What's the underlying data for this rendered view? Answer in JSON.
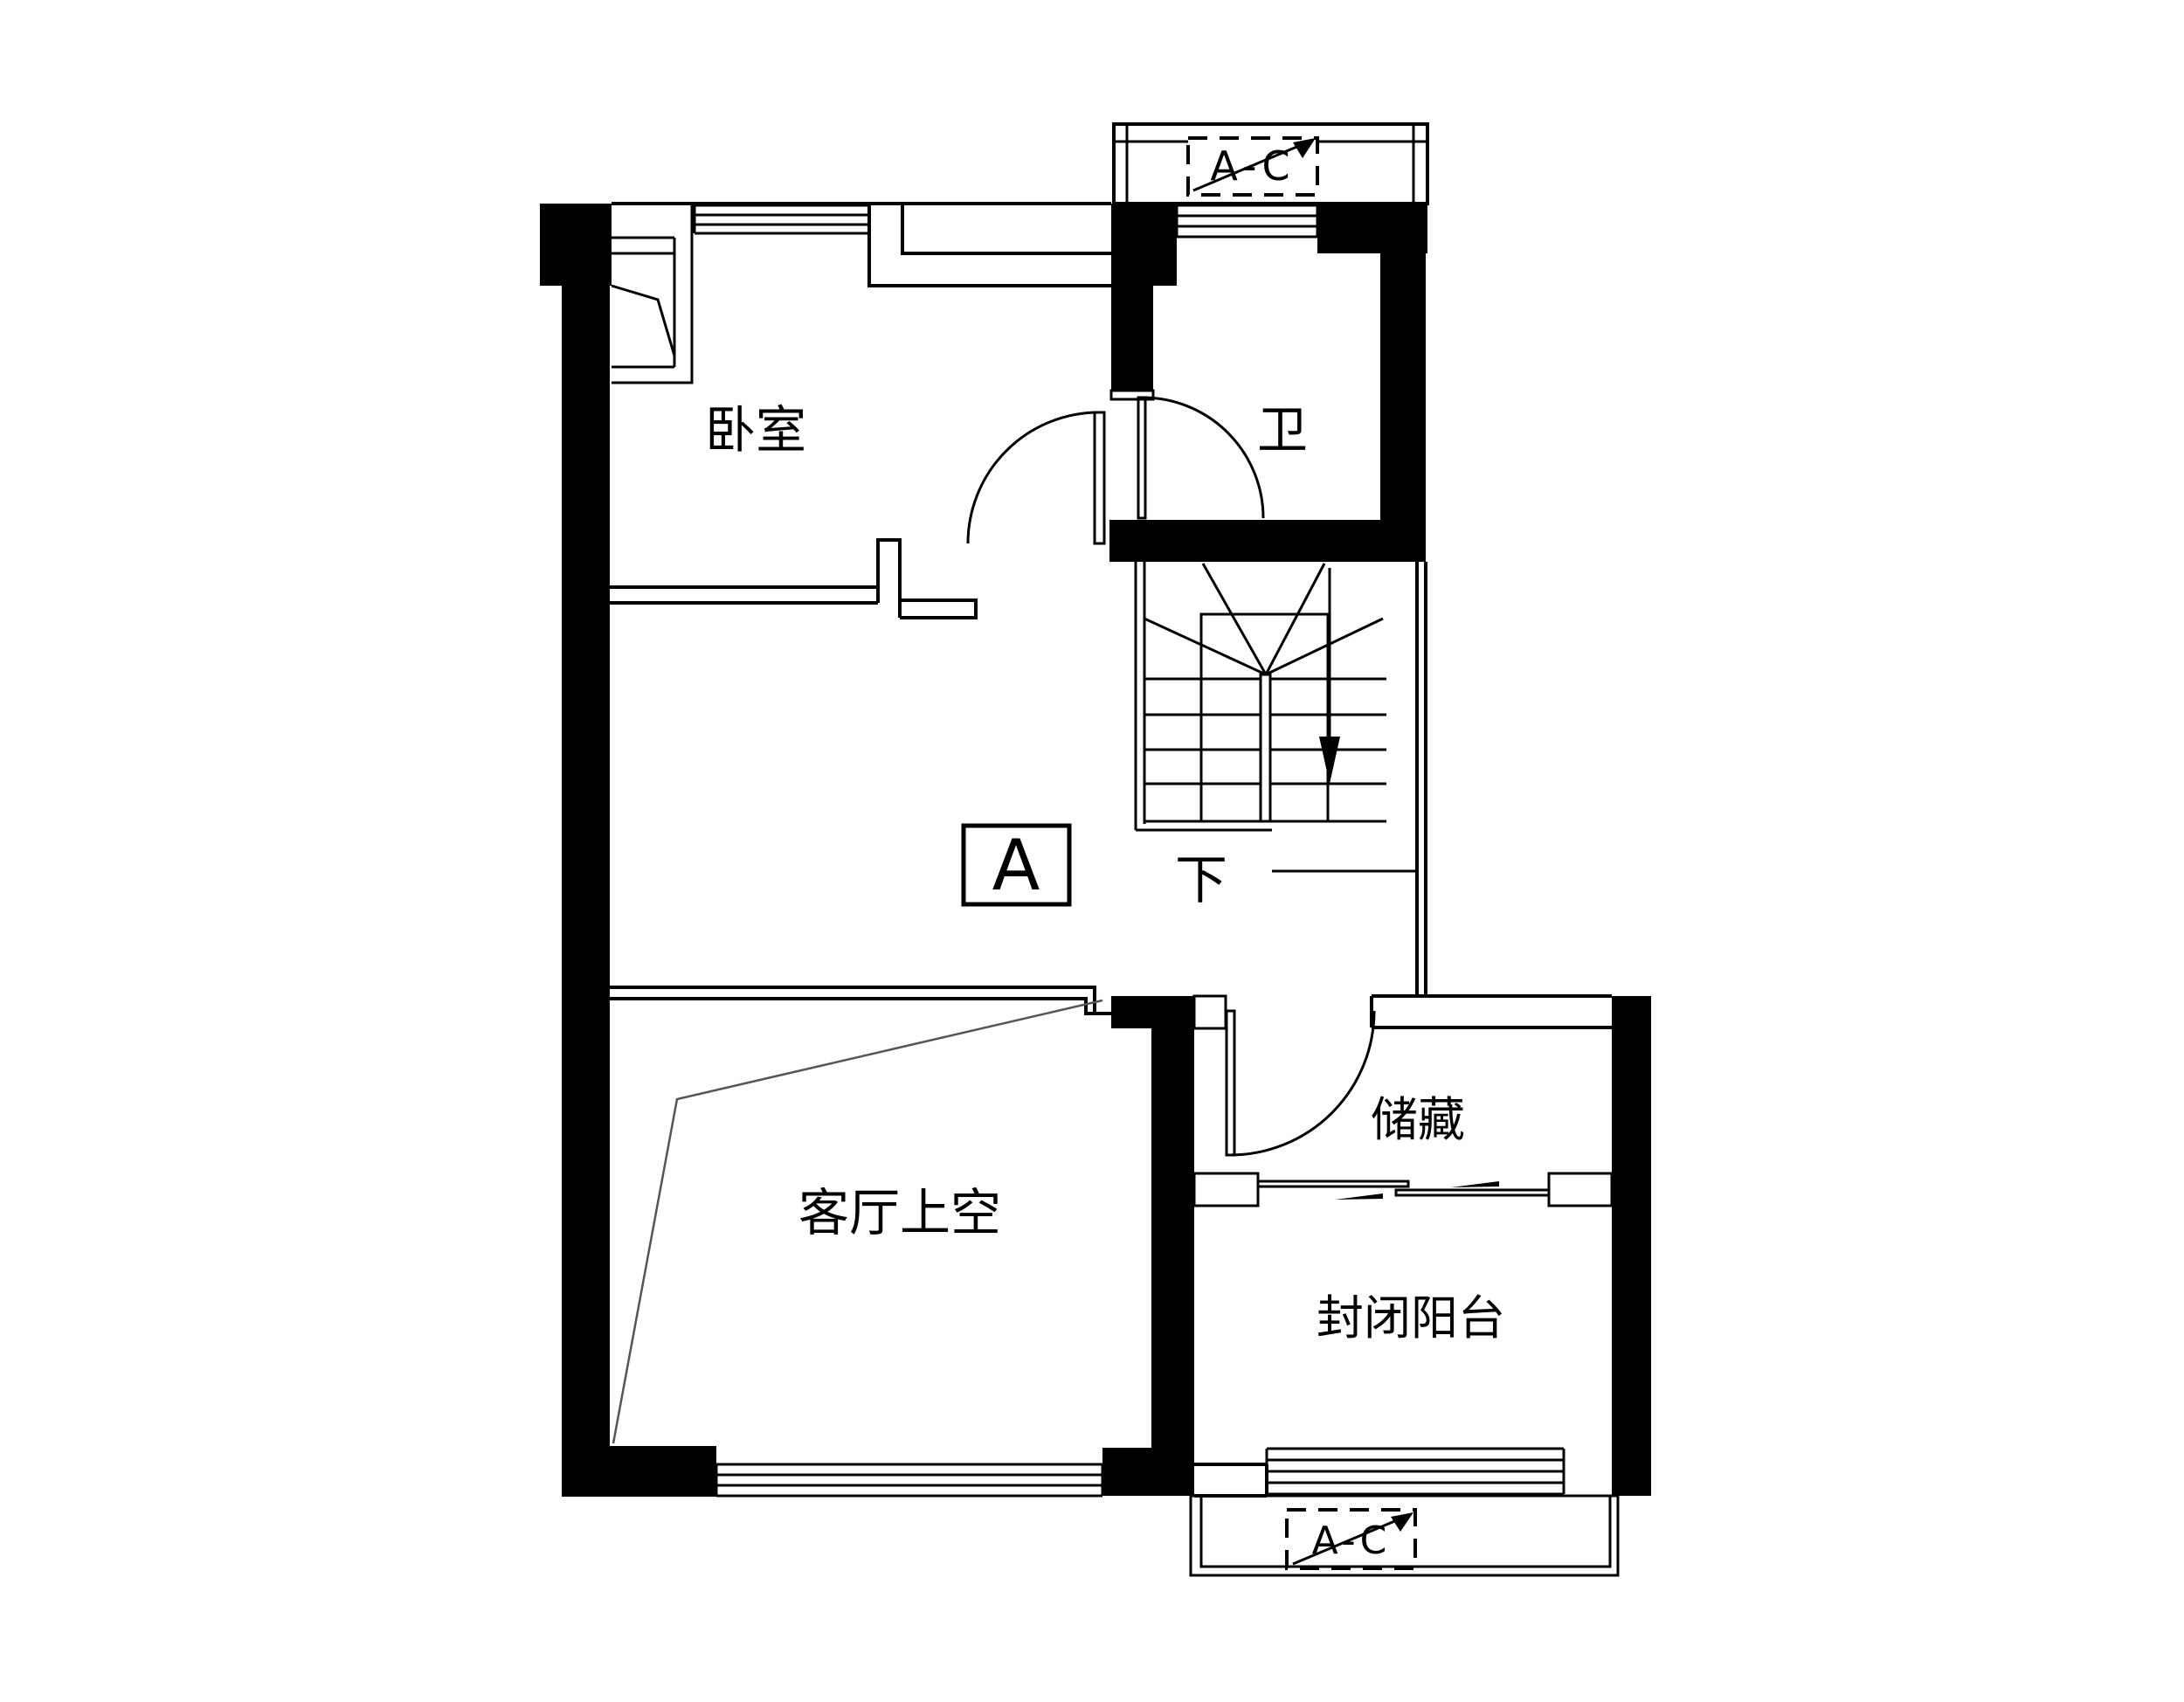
{
  "drawing": {
    "type": "residential-floor-plan-upper-level",
    "rooms": {
      "bedroom": "卧室",
      "bathroom": "卫",
      "living_void": "客厅上空",
      "storage": "储藏",
      "balcony": "封闭阳台"
    },
    "stairs": {
      "direction_label": "下"
    },
    "markers": {
      "section": "A",
      "ac_top": "A-C",
      "ac_bottom": "A-C"
    },
    "colors": {
      "line": "#000000",
      "background": "#ffffff"
    }
  }
}
